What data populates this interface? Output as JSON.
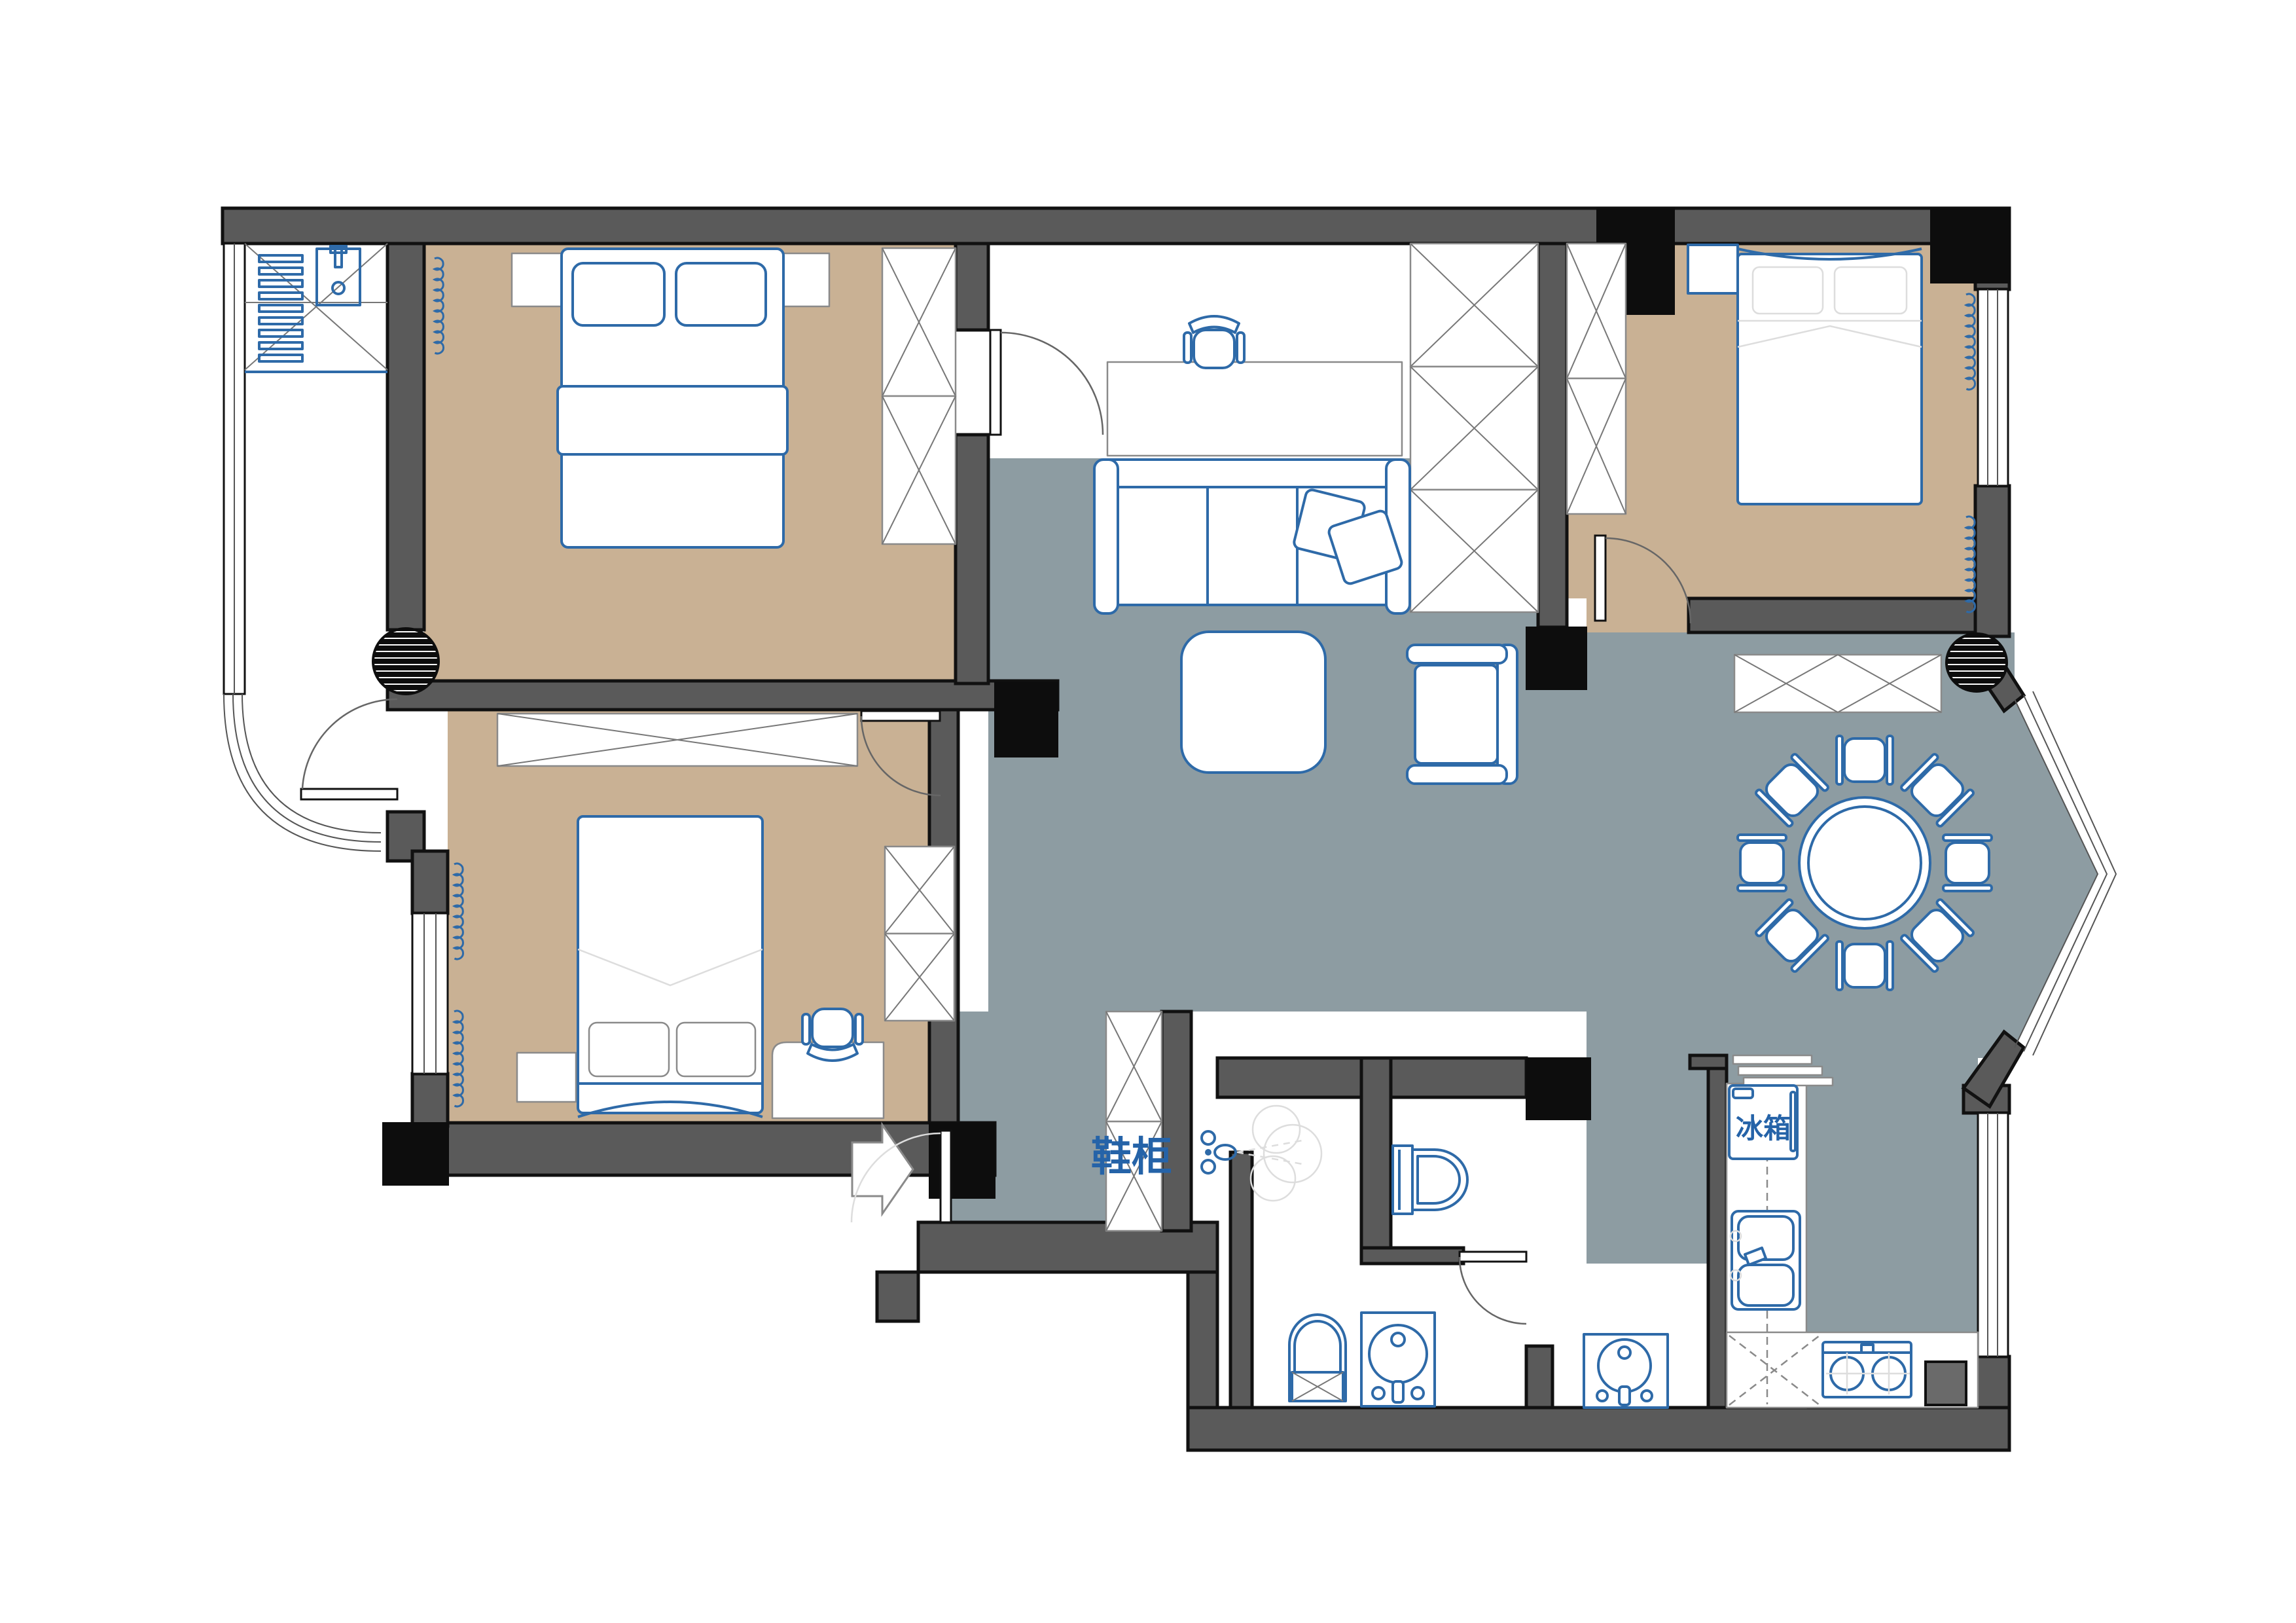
{
  "drawing": {
    "type": "apartment-floor-plan",
    "labels": {
      "shoe_cabinet": "鞋柜",
      "fridge": "冰箱"
    },
    "colors": {
      "wall": "#5a5a5a",
      "wall_outline": "#111111",
      "structural_column": "#0d0d0d",
      "bedroom_floor": "#c9b194",
      "living_floor": "#8d9ca2",
      "furniture_line": "#2e6aa8",
      "label_blue": "#2563a8",
      "detail_line": "#8a8a8a"
    },
    "rooms": [
      {
        "name": "balcony-utility",
        "floor": "white",
        "furniture": [
          "drying-rack",
          "utility-sink",
          "curved-corner-window",
          "balcony-door"
        ]
      },
      {
        "name": "bedroom-top-left",
        "floor": "tan",
        "furniture": [
          "double-bed",
          "pillows",
          "nightstand-left",
          "nightstand-right",
          "wardrobe",
          "curtain"
        ]
      },
      {
        "name": "bedroom-bottom-left",
        "floor": "tan",
        "furniture": [
          "double-bed",
          "pillows",
          "dresser",
          "nightstand",
          "desk",
          "office-chair",
          "wardrobe",
          "curtain",
          "window"
        ]
      },
      {
        "name": "study-nook",
        "floor": "white",
        "furniture": [
          "desk",
          "office-chair",
          "storage-closet"
        ]
      },
      {
        "name": "living-room",
        "floor": "gray",
        "furniture": [
          "sofa",
          "throw-pillows",
          "coffee-table",
          "armchair"
        ]
      },
      {
        "name": "bedroom-top-right",
        "floor": "tan",
        "furniture": [
          "double-bed",
          "pillows",
          "nightstand",
          "wardrobe",
          "curtains",
          "window",
          "sideboard"
        ]
      },
      {
        "name": "dining-room",
        "floor": "gray",
        "furniture": [
          "round-dining-table",
          "eight-chairs",
          "bay-window"
        ]
      },
      {
        "name": "kitchen",
        "floor": "gray",
        "furniture": [
          "fridge",
          "double-bowl-sink",
          "gas-stove",
          "counters",
          "shelves",
          "window"
        ]
      },
      {
        "name": "wc-toilet-room",
        "floor": "white",
        "furniture": [
          "toilet"
        ]
      },
      {
        "name": "bathroom-main",
        "floor": "white",
        "furniture": [
          "toilet",
          "washbasin"
        ]
      },
      {
        "name": "washbasin-room",
        "floor": "white",
        "furniture": [
          "washbasin"
        ]
      },
      {
        "name": "entry-foyer",
        "floor": "white",
        "furniture": [
          "shoe-cabinet",
          "shower-sprayer",
          "entry-arrow",
          "entry-door"
        ]
      }
    ]
  }
}
